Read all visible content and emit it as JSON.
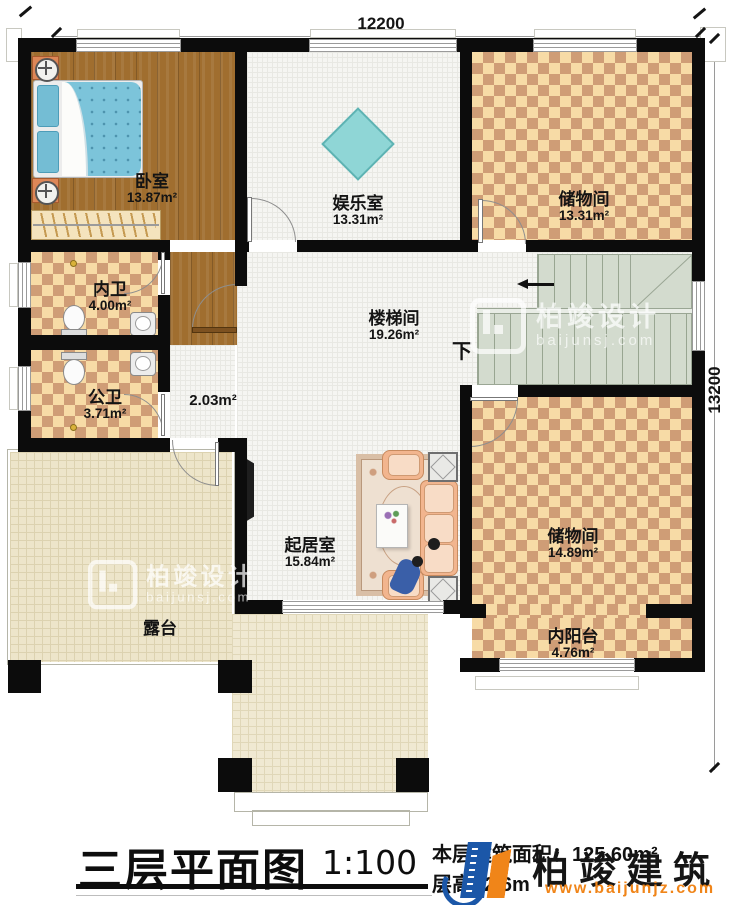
{
  "dimensions": {
    "width": "12200",
    "height": "13200"
  },
  "rooms": {
    "bedroom": {
      "name": "卧室",
      "area": "13.87m²"
    },
    "entertainment": {
      "name": "娱乐室",
      "area": "13.31m²"
    },
    "storage_top": {
      "name": "储物间",
      "area": "13.31m²"
    },
    "inner_bath": {
      "name": "内卫",
      "area": "4.00m²"
    },
    "public_bath": {
      "name": "公卫",
      "area": "3.71m²"
    },
    "hall": {
      "area": "2.03m²"
    },
    "stair_hall": {
      "name": "楼梯间",
      "area": "19.26m²"
    },
    "storage_right": {
      "name": "储物间",
      "area": "14.89m²"
    },
    "living": {
      "name": "起居室",
      "area": "15.84m²"
    },
    "inner_balcony": {
      "name": "内阳台",
      "area": "4.76m²"
    },
    "terrace": {
      "name": "露台"
    }
  },
  "stairs": {
    "down_label": "下"
  },
  "title_block": {
    "title": "三层平面图",
    "scale": "1:100",
    "area_label": "本层建筑面积：",
    "area_value": "125.60m²",
    "floor_height": "层高: 2.6m"
  },
  "brand": {
    "logo_text": "柏竣建筑",
    "website": "www.baijunjz.com"
  },
  "watermark": {
    "name": "柏竣设计",
    "url": "baijunsj.com"
  },
  "colors": {
    "wall": "#0c0c0c",
    "checker": "#cf9d76",
    "checker_light": "#f7dba6",
    "wood": "#9e6c2e",
    "stairs": "#d3dbce",
    "terrace": "#ede5ca",
    "logo_blue": "#1b57a8",
    "logo_orange": "#f08519"
  }
}
